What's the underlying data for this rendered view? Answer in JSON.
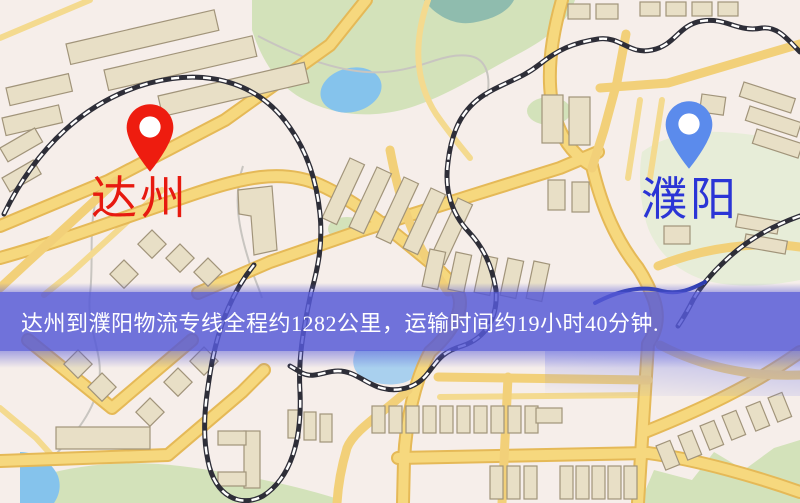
{
  "origin": {
    "name": "达州"
  },
  "destination": {
    "name": "濮阳"
  },
  "banner": {
    "text": "达州到濮阳物流专线全程约1282公里，运输时间约19小时40分钟."
  },
  "route": {
    "distance_km": 1282,
    "distance_text": "全程约1282公里",
    "duration_text": "运输时间约19小时40分钟"
  },
  "icons": {
    "origin_pin": "location-pin-icon",
    "destination_pin": "location-pin-icon"
  },
  "colors": {
    "origin_pin": "#ee1c0f",
    "origin_label": "#e71a10",
    "destination_pin": "#5b8bec",
    "destination_label": "#2b35d6",
    "banner_bg": "#5659d7",
    "banner_text": "#ffffff",
    "road": "#f6d87e",
    "road_edge": "#e5b957",
    "building": "#e8dfc6",
    "park": "#d3e2ba",
    "water": "#85c3ec",
    "railway": "#2e2e38"
  }
}
